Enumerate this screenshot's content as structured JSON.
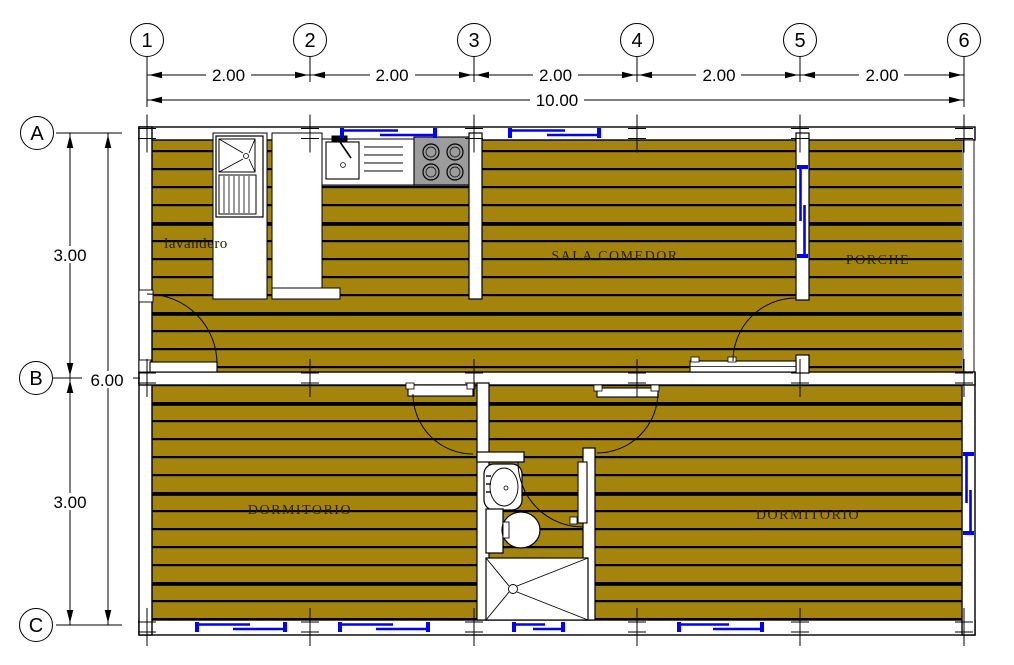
{
  "drawing": {
    "title_hint": "house floor plan",
    "grid": {
      "columns": [
        "1",
        "2",
        "3",
        "4",
        "5",
        "6"
      ],
      "rows": [
        "A",
        "B",
        "C"
      ]
    },
    "dimensions": {
      "top_segments": [
        "2.00",
        "2.00",
        "2.00",
        "2.00",
        "2.00"
      ],
      "top_total": "10.00",
      "left_segments": [
        "3.00",
        "3.00"
      ],
      "left_total": "6.00"
    },
    "rooms": {
      "laundry": "lavandero",
      "living": "SALA COMEDOR",
      "porch": "PORCHE",
      "bedroom_left": "DORMITORIO",
      "bedroom_right": "DORMITORIO"
    },
    "colors": {
      "floor": "#A4840B",
      "stove": "#9C9C9C",
      "window": "#0000FF",
      "line": "#000000",
      "background": "#FFFFFF"
    }
  }
}
